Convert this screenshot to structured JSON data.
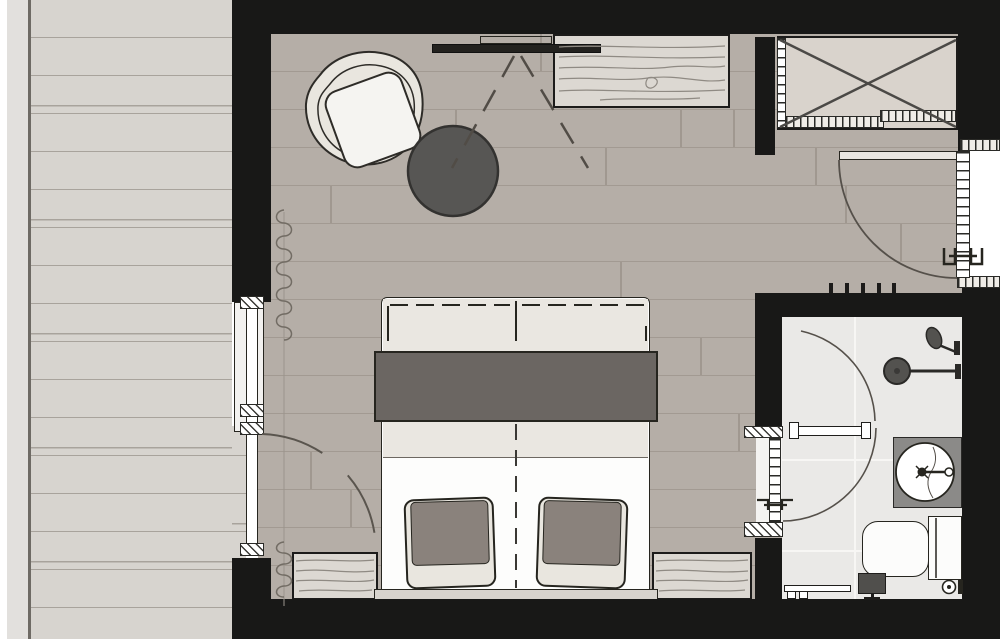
{
  "title": "Hotel guest room floor plan",
  "palette": {
    "wall": "#181817",
    "bedroom_floor": "#b5aea7",
    "terrace_deck": "#d7d4cf",
    "bathroom_floor": "#eae9e7",
    "wood_furniture": "#dcd8d2",
    "blanket_dark": "#6b6662",
    "duvet_cream": "#eae7e1",
    "pillow_cushion": "#8a827c",
    "side_table_gray": "#575654",
    "vanity_gray": "#8b8a88",
    "fixture_dark": "#53524f"
  },
  "rooms": {
    "terrace": {
      "label": "Terrace with wood decking"
    },
    "bedroom": {
      "label": "Bedroom",
      "items": {
        "armchair": {
          "label": "Lounge armchair"
        },
        "side_table": {
          "label": "Round side table"
        },
        "tv": {
          "label": "Wall-mounted TV with viewing angle"
        },
        "sideboard": {
          "label": "Wooden sideboard"
        },
        "wardrobe": {
          "label": "Built-in wardrobe with clothes rail"
        },
        "entry_door": {
          "label": "Entrance door with swing arc"
        },
        "double_bed": {
          "label": "Double bed with throw blanket and two pillows"
        },
        "nightstand_left": {
          "label": "Nightstand left"
        },
        "nightstand_right": {
          "label": "Nightstand right"
        },
        "window": {
          "label": "Window to terrace"
        },
        "terrace_door": {
          "label": "Terrace door with swing arc"
        },
        "curtain": {
          "label": "Curtain along window"
        },
        "radiator_ticks": {
          "label": "Wall heating element"
        }
      }
    },
    "bathroom": {
      "label": "Bathroom",
      "items": {
        "shower": {
          "label": "Walk-in shower with rain head and hand shower"
        },
        "shower_partition": {
          "label": "Glass shower partition"
        },
        "washbasin": {
          "label": "Round washbasin on vanity counter"
        },
        "toilet": {
          "label": "Toilet with cistern"
        },
        "toilet_paper_holder": {
          "label": "Toilet paper holder"
        },
        "towel_rail": {
          "label": "Towel rail"
        },
        "stool": {
          "label": "Stool"
        },
        "bathroom_door": {
          "label": "Bathroom door with swing arc"
        }
      }
    }
  }
}
